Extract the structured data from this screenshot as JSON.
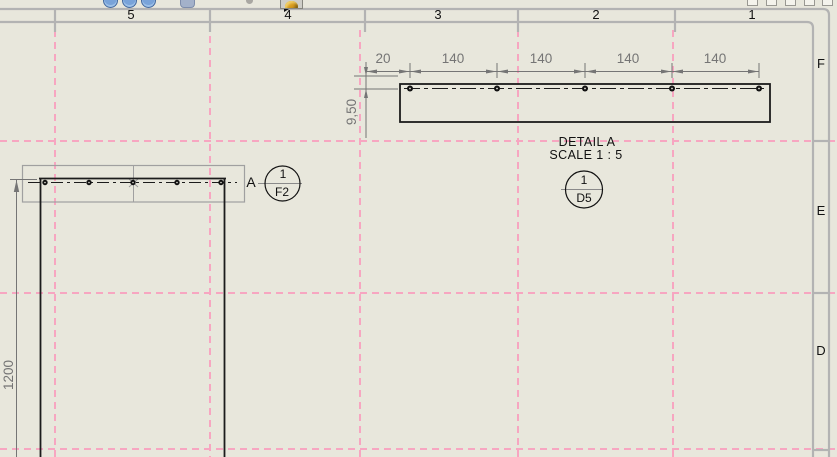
{
  "window": {
    "description": "CAD drawing sheet viewport"
  },
  "zone_border": {
    "columns": [
      "5",
      "4",
      "3",
      "2",
      "1"
    ],
    "rows": [
      "F",
      "E",
      "D"
    ]
  },
  "views": {
    "main_view": {
      "detail_label": "A",
      "length_dimension": "1200",
      "callout": {
        "top": "1",
        "bottom": "F2"
      }
    },
    "detail_view": {
      "title": "DETAIL A",
      "scale": "SCALE 1 : 5",
      "callout": {
        "top": "1",
        "bottom": "D5"
      },
      "dimensions": {
        "edge_offset": "20",
        "hole_pitch": [
          "140",
          "140",
          "140",
          "140"
        ],
        "depth": "9,50"
      }
    }
  },
  "colors": {
    "sheet": "#e8e7dc",
    "frame_gray": "#b3b3b3",
    "grid_pink": "#f7a6c1",
    "dimension_gray": "#757575",
    "line_black": "#1c1c1c",
    "toolbar_gold": "#d89c1e"
  }
}
